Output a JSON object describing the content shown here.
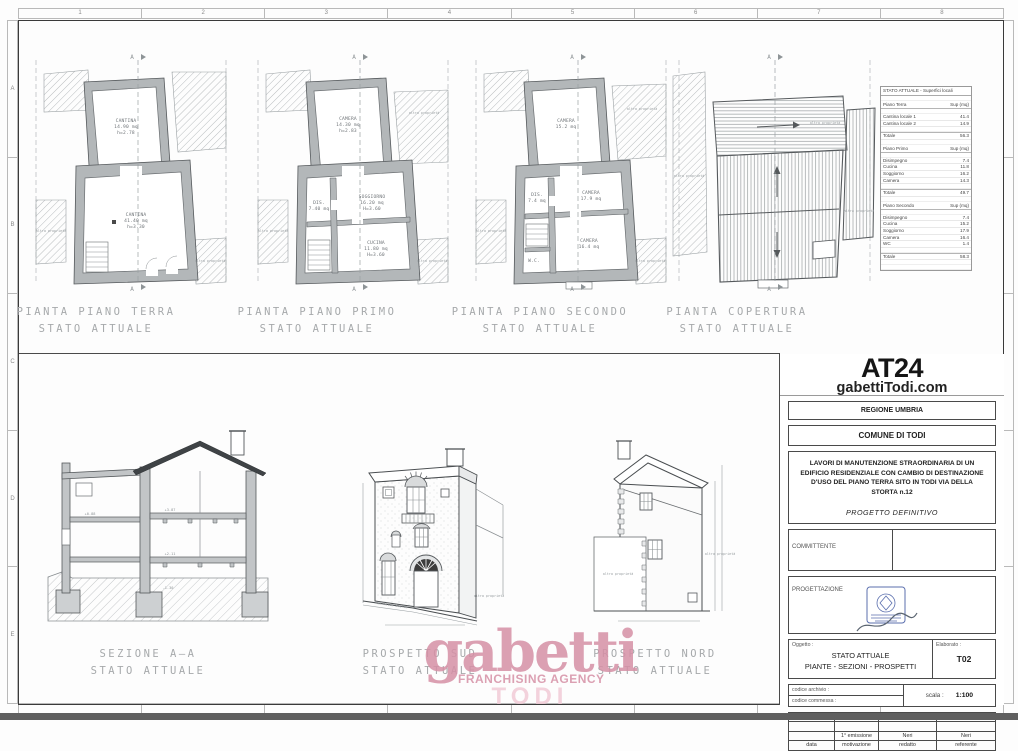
{
  "frame": {
    "cols": [
      "1",
      "2",
      "3",
      "4",
      "5",
      "6",
      "7",
      "8"
    ],
    "rows": [
      "A",
      "B",
      "C",
      "D",
      "E"
    ]
  },
  "labels": {
    "stato_attuale": "STATO ATTUALE",
    "plan_terra": "PIANTA PIANO TERRA",
    "plan_primo": "PIANTA PIANO PRIMO",
    "plan_secondo": "PIANTA PIANO SECONDO",
    "plan_copertura": "PIANTA COPERTURA",
    "sezione": "SEZIONE A—A",
    "prospetto_sud": "PROSPETTO SUD",
    "prospetto_nord": "PROSPETTO NORD"
  },
  "annotations": {
    "altra_proprieta": "altra proprietà",
    "via_della_storta": "Via della Storta",
    "section_marker": "A",
    "levels": {
      "l1": "+3.87",
      "l2": "+2.11",
      "l3": "-1.30",
      "l4": "+0.88"
    }
  },
  "rooms": {
    "terra": {
      "r1_name": "CANTINA",
      "r1_area": "14.90 mq",
      "r1_h": "h=2.78",
      "r2_name": "CANTINA",
      "r2_area": "41.40 mq",
      "r2_h": "h=3.30"
    },
    "primo": {
      "r1_name": "CAMERA",
      "r1_area": "14.30 mq",
      "r1_h": "h=2.83",
      "r2_name": "SOGGIORNO",
      "r2_area": "16.20 mq",
      "r2_h": "H=3.60",
      "r3_name": "CUCINA",
      "r3_area": "11.80 mq",
      "r3_h": "H=3.60",
      "r4_name": "DIS.",
      "r4_area": "7.40 mq"
    },
    "secondo": {
      "r1_name": "CAMERA",
      "r1_area": "15.2 mq",
      "r2_name": "CAMERA",
      "r2_area": "17.9 mq",
      "r3_name": "CAMERA",
      "r3_area": "16.4 mq",
      "r4_name": "DIS.",
      "r4_area": "7.4 mq",
      "r5_name": "W.C."
    }
  },
  "surfaces_table": {
    "title": "STATO ATTUALE - Superfici locali",
    "col_header": "Sup (mq)",
    "piano_terra": {
      "header": "Piano Terra",
      "rows": [
        [
          "Cantina locale 1",
          "41.4"
        ],
        [
          "Cantina locale 2",
          "14.9"
        ]
      ],
      "total_label": "Totale",
      "total": "56.3"
    },
    "piano_primo": {
      "header": "Piano Primo",
      "rows": [
        [
          "Disimpegno",
          "7.4"
        ],
        [
          "Cucina",
          "11.8"
        ],
        [
          "Soggiorno",
          "16.2"
        ],
        [
          "Camera",
          "14.3"
        ]
      ],
      "total_label": "Totale",
      "total": "49.7"
    },
    "piano_secondo": {
      "header": "Piano Secondo",
      "rows": [
        [
          "Disimpegno",
          "7.4"
        ],
        [
          "Cucina",
          "15.2"
        ],
        [
          "Soggiorno",
          "17.9"
        ],
        [
          "Camera",
          "16.4"
        ],
        [
          "WC",
          "1.4"
        ]
      ],
      "total_label": "Totale",
      "total": "58.3"
    }
  },
  "title_block": {
    "code": "AT24",
    "website": "gabettiTodi.com",
    "regione": "REGIONE UMBRIA",
    "comune": "COMUNE DI TODI",
    "project_title": "LAVORI DI MANUTENZIONE STRAORDINARIA DI UN EDIFICIO RESIDENZIALE CON CAMBIO DI DESTINAZIONE D'USO DEL PIANO TERRA SITO IN TODI VIA DELLA STORTA n.12",
    "phase": "PROGETTO DEFINITIVO",
    "committente": "COMMITTENTE",
    "progettazione": "PROGETTAZIONE",
    "oggetto_label": "Oggetto :",
    "oggetto_line1": "STATO ATTUALE",
    "oggetto_line2": "PIANTE - SEZIONI - PROSPETTI",
    "elaborato_label": "Elaborato :",
    "elaborato": "T02",
    "codice_archivio": "codice archivio :",
    "codice_commessa": "codice commessa :",
    "scala_label": "scala :",
    "scala": "1:100",
    "rev_emissione": "1° emissione",
    "rev_redatto": "Neri",
    "rev_referente": "Neri",
    "rev_headers": [
      "data",
      "motivazione",
      "redatto",
      "referente"
    ]
  },
  "watermark": {
    "brand": "gabetti",
    "tagline": "FRANCHISING AGENCY",
    "city": "TODI",
    "color": "#d690a6"
  }
}
